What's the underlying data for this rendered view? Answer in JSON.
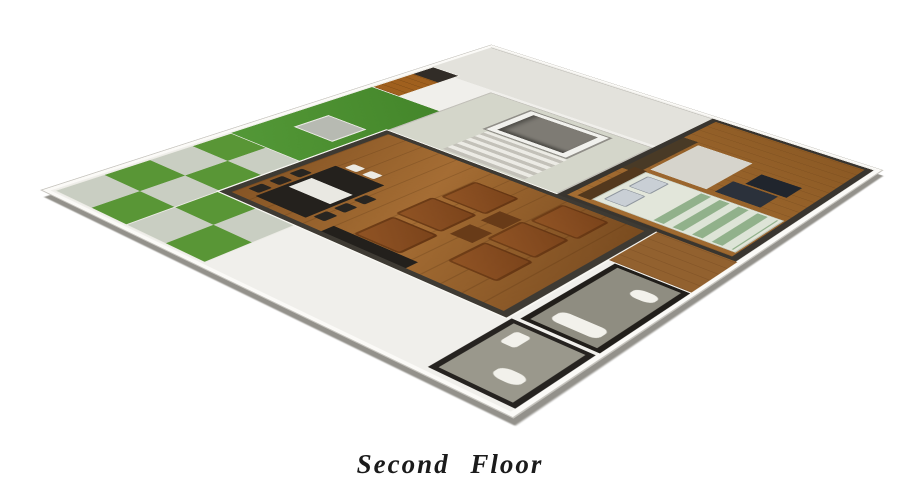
{
  "caption": {
    "text": "Second Floor"
  },
  "floor_plan": {
    "type": "3d-isometric-floor-plan-render",
    "regions": [
      "terrace-checker-tiles",
      "lawn",
      "wood-deck",
      "stair-hall",
      "staircase",
      "stairwell-opening",
      "living-room",
      "bedroom",
      "bathroom-left",
      "bathroom-right",
      "hallway"
    ],
    "furniture": [
      "dining-table",
      "dining-chairs",
      "sofa-blocks",
      "coffee-tables",
      "tv-cabinet",
      "lawn-table",
      "double-bed",
      "pillows",
      "bedside-chests",
      "dresser",
      "rug",
      "toilet",
      "sink",
      "bathtub"
    ]
  },
  "colors": {
    "background": "#ffffff",
    "slab": "#f0efeb",
    "grass_green": "#46912a",
    "pale_tile": "#c9cec1",
    "wood_floor": "#9b6227",
    "sofa_brown": "#8c4c1e",
    "wall_dark": "#36322b",
    "deck_wood": "#a55f17",
    "bed_green": "#8fb289",
    "navy_chest": "#2b313c",
    "caption_text": "#1b1b1b"
  }
}
